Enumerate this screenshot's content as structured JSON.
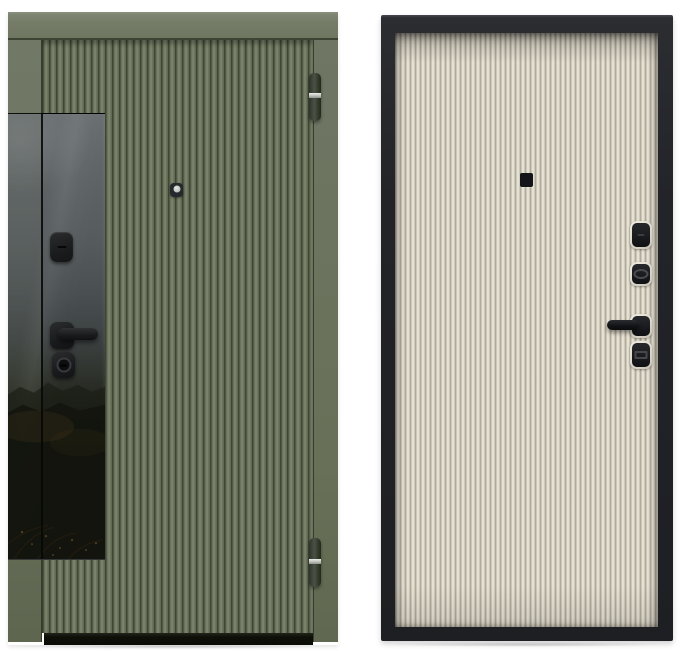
{
  "colors": {
    "bg": "#ffffff",
    "ext-frame": "#737a66",
    "ext-leaf-ridge": "#7e8570",
    "ext-leaf-groove": "#3f4634",
    "ext-dark-line": "#363d2c",
    "glass-top": "#686e70",
    "glass-bottom": "#060606",
    "hardware-black": "#1b1c1e",
    "hinge-band": "#d8dad4",
    "peephole-lens": "#cdd1cc",
    "threshold": "#0e1008",
    "int-frame": "#232428",
    "int-panel-ridge": "#f0ebe0",
    "int-panel-groove": "#a9a393",
    "int-bezel": "#dcd8ca"
  },
  "exterior_door": {
    "finish": "olive green fluted door, exterior side",
    "parts": {
      "frame_header": "frame header",
      "frame_jamb_left": "frame left jamb",
      "frame_jamb_right": "frame right jamb",
      "leaf": "fluted door leaf",
      "glass_insert": "tinted glass insert with landscape reflection",
      "glass_seam": "leaf-to-frame seam over glass",
      "thumbturn": "thumbturn escutcheon",
      "handle": "lever handle",
      "cylinder": "cylinder lock",
      "peephole": "peephole viewer",
      "hinge_top": "top hinge",
      "hinge_bottom": "bottom hinge",
      "threshold": "threshold bar"
    }
  },
  "interior_door": {
    "finish": "cream fluted door in black frame, interior side",
    "parts": {
      "frame": "black door frame",
      "panel": "fluted cream door leaf",
      "peephole": "peephole viewer",
      "latch_escutcheon": "night-latch escutcheon",
      "keyhole_escutcheon": "oval keyhole escutcheon",
      "handle_escutcheon": "handle escutcheon",
      "handle": "lever handle",
      "deadbolt_escutcheon": "deadbolt slot escutcheon"
    }
  }
}
